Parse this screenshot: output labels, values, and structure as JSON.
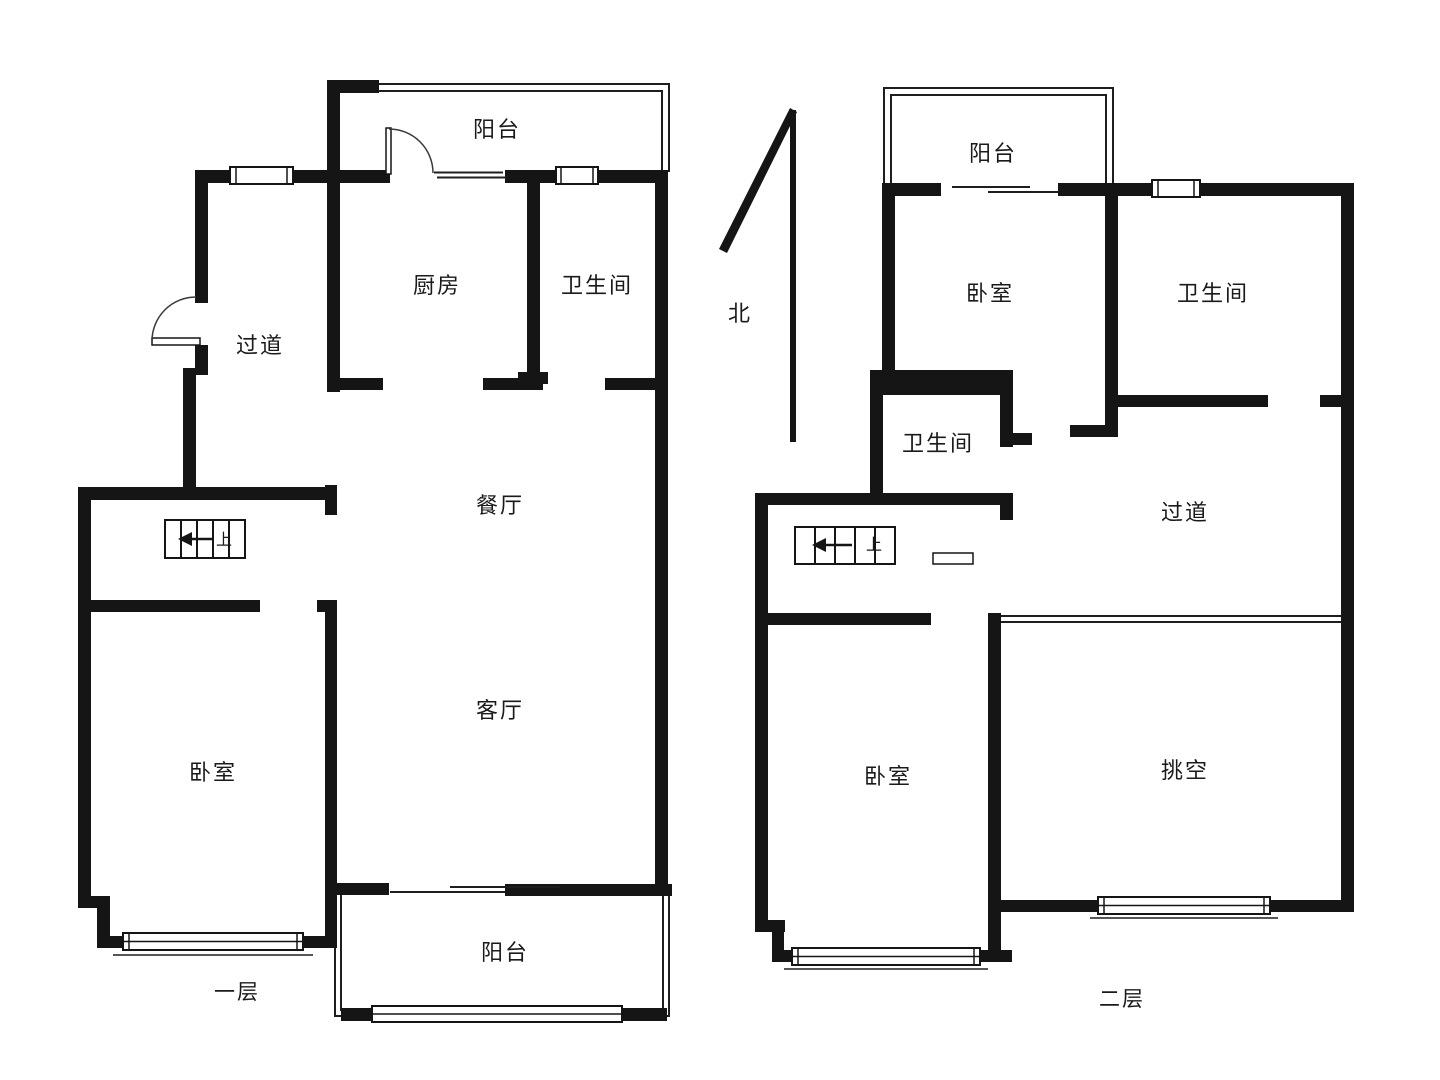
{
  "compass": {
    "label": "北"
  },
  "floor1": {
    "name": "一层",
    "stairs_up_label": "上",
    "rooms": {
      "balcony_top": "阳台",
      "kitchen": "厨房",
      "bathroom": "卫生间",
      "hallway": "过道",
      "dining": "餐厅",
      "living": "客厅",
      "bedroom": "卧室",
      "balcony_bottom": "阳台"
    }
  },
  "floor2": {
    "name": "二层",
    "stairs_up_label": "上",
    "rooms": {
      "balcony": "阳台",
      "bedroom_north": "卧室",
      "bathroom_east": "卫生间",
      "bathroom_small": "卫生间",
      "hallway": "过道",
      "bedroom_south": "卧室",
      "void": "挑空"
    }
  },
  "colors": {
    "wall": "#151515",
    "background": "#ffffff"
  }
}
